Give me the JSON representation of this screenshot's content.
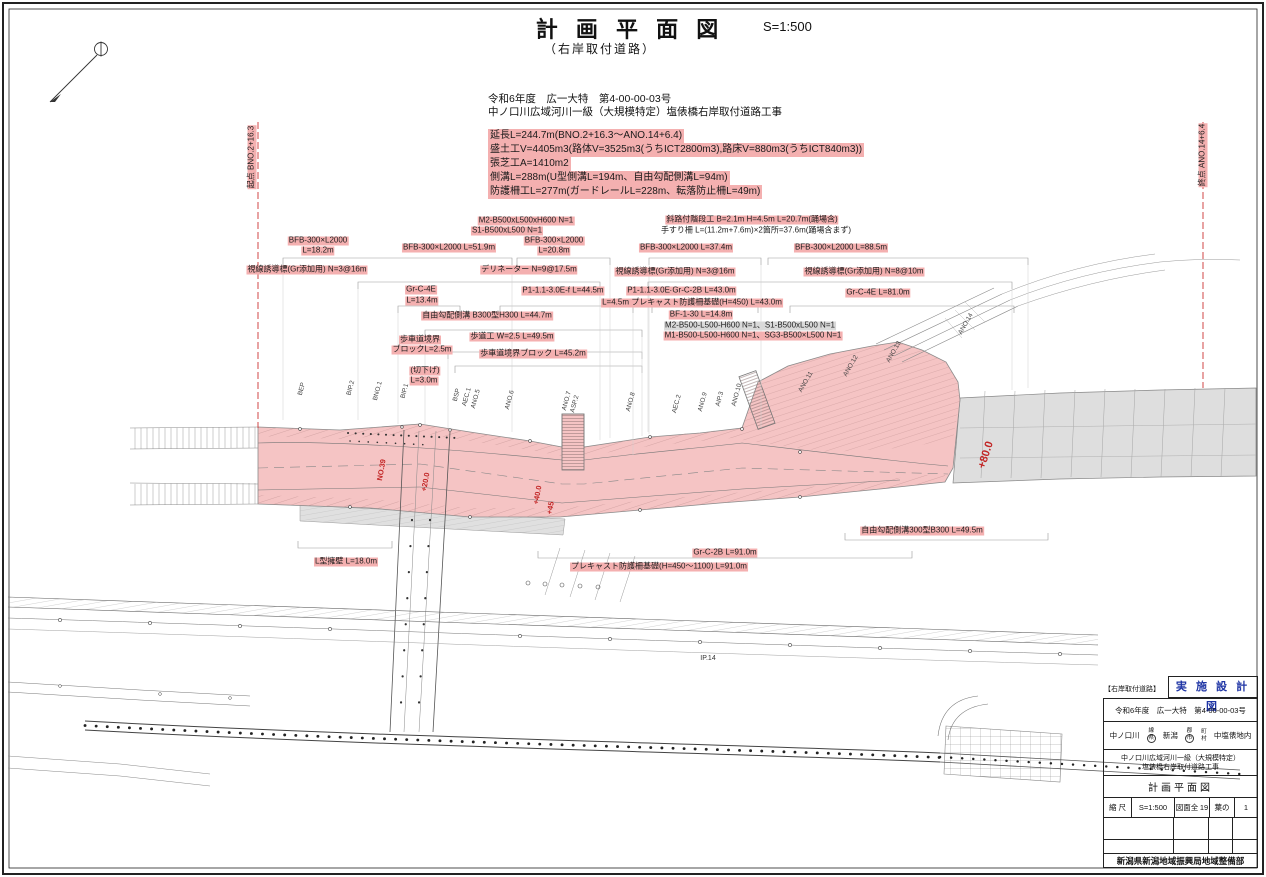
{
  "page": {
    "title": "計 画 平 面 図",
    "scale": "S=1:500",
    "subtitle": "（右岸取付道路）",
    "header1": "令和6年度　広一大特　第4-00-00-03号",
    "header2": "中ノ口川広域河川一級（大規模特定）塩俵橋右岸取付道路工事"
  },
  "colors": {
    "highlight_pink": "#f4b0b0",
    "embankment_pink": "#f5c4c4",
    "existing_gray": "#dedede",
    "chainage_red": "#c22626",
    "stamp_blue": "#1f35a5"
  },
  "summary": {
    "lines": [
      "延長L=244.7m(BNO.2+16.3〜ANO.14+6.4)",
      "盛土工V=4405m3(路体V=3525m3(うちICT2800m3),路床V=880m3(うちICT840m3))",
      "張芝工A=1410m2",
      "側溝L=288m(U型側溝L=194m、自由勾配側溝L=94m)",
      "防護柵工L=277m(ガードレールL=228m、転落防止柵L=49m)"
    ]
  },
  "map_labels": [
    {
      "t": "M2-B500xL500xH600 N=1",
      "x": 526,
      "y": 221,
      "bg": "pink"
    },
    {
      "t": "S1-B500xL500 N=1",
      "x": 507,
      "y": 231,
      "bg": "pink"
    },
    {
      "t": "BFB-300×L2000",
      "x": 318,
      "y": 241,
      "bg": "pink"
    },
    {
      "t": "L=18.2m",
      "x": 318,
      "y": 251,
      "bg": "pink"
    },
    {
      "t": "BFB-300×L2000 L=51.9m",
      "x": 449,
      "y": 248,
      "bg": "pink"
    },
    {
      "t": "BFB-300×L2000",
      "x": 554,
      "y": 241,
      "bg": "pink"
    },
    {
      "t": "L=20.8m",
      "x": 554,
      "y": 251,
      "bg": "pink"
    },
    {
      "t": "斜路付階段工 B=2.1m H=4.5m L=20.7m(踊場含)",
      "x": 752,
      "y": 220,
      "bg": "pink"
    },
    {
      "t": "手すり柵 L=(11.2m+7.6m)×2箇所=37.6m(踊場含まず)",
      "x": 756,
      "y": 231
    },
    {
      "t": "BFB-300×L2000 L=37.4m",
      "x": 686,
      "y": 248,
      "bg": "pink"
    },
    {
      "t": "BFB-300×L2000 L=88.5m",
      "x": 841,
      "y": 248,
      "bg": "pink"
    },
    {
      "t": "視線誘導標(Gr添加用) N=3@16m",
      "x": 307,
      "y": 270,
      "bg": "pink"
    },
    {
      "t": "デリネーター N=9@17.5m",
      "x": 529,
      "y": 270,
      "bg": "pink"
    },
    {
      "t": "視線誘導標(Gr添加用) N=3@16m",
      "x": 675,
      "y": 272,
      "bg": "pink"
    },
    {
      "t": "視線誘導標(Gr添加用) N=8@10m",
      "x": 864,
      "y": 272,
      "bg": "pink"
    },
    {
      "t": "Gr-C-4E",
      "x": 421,
      "y": 290,
      "bg": "pink"
    },
    {
      "t": "L=13.4m",
      "x": 422,
      "y": 301,
      "bg": "pink"
    },
    {
      "t": "P1-1.1-3.0E-f L=44.5m",
      "x": 563,
      "y": 291,
      "bg": "pink"
    },
    {
      "t": "P1-1.1-3.0E-f",
      "x": 651,
      "y": 291,
      "bg": "pink"
    },
    {
      "t": "Gr-C-2B L=43.0m",
      "x": 704,
      "y": 291,
      "bg": "pink"
    },
    {
      "t": "Gr-C-4E L=81.0m",
      "x": 878,
      "y": 293,
      "bg": "pink"
    },
    {
      "t": "L=4.5m プレキャスト防護柵基礎(H=450) L=43.0m",
      "x": 692,
      "y": 303,
      "bg": "pink"
    },
    {
      "t": "自由勾配側溝 B300型H300 L=44.7m",
      "x": 487,
      "y": 316,
      "bg": "pink"
    },
    {
      "t": "BF-1-30 L=14.8m",
      "x": 701,
      "y": 315,
      "bg": "pink"
    },
    {
      "t": "M2-B500-L500-H600 N=1、S1-B500xL500 N=1",
      "x": 750,
      "y": 326,
      "bg": "gray"
    },
    {
      "t": "M1-B500-L500-H600 N=1、SG3-B500×L500 N=1",
      "x": 753,
      "y": 336,
      "bg": "pink"
    },
    {
      "t": "歩道工 W=2.5 L=49.5m",
      "x": 512,
      "y": 337,
      "bg": "pink"
    },
    {
      "t": "歩車道境界",
      "x": 420,
      "y": 340,
      "bg": "pink"
    },
    {
      "t": "ブロックL=2.5m",
      "x": 422,
      "y": 350,
      "bg": "pink"
    },
    {
      "t": "歩車道境界ブロック L=45.2m",
      "x": 533,
      "y": 354,
      "bg": "pink"
    },
    {
      "t": "(切下げ)",
      "x": 425,
      "y": 371,
      "bg": "pink"
    },
    {
      "t": "L=3.0m",
      "x": 424,
      "y": 381,
      "bg": "pink"
    },
    {
      "t": "L型擁壁 L=18.0m",
      "x": 346,
      "y": 562,
      "bg": "pink"
    },
    {
      "t": "Gr-C-2B L=91.0m",
      "x": 725,
      "y": 553,
      "bg": "pink"
    },
    {
      "t": "プレキャスト防護柵基礎(H=450〜1100) L=91.0m",
      "x": 659,
      "y": 567,
      "bg": "pink"
    },
    {
      "t": "自由勾配側溝300型B300 L=49.5m",
      "x": 922,
      "y": 531,
      "bg": "pink"
    },
    {
      "t": "起点 BNO.2+16.3",
      "x": 252,
      "y": 157,
      "rot": -90,
      "bg": "pink"
    },
    {
      "t": "終点 ANO.14+6.4",
      "x": 1203,
      "y": 155,
      "rot": -90,
      "bg": "pink"
    },
    {
      "t": "BEP",
      "x": 302,
      "y": 389,
      "rot": -75,
      "cls": "sta"
    },
    {
      "t": "BIP.2",
      "x": 351,
      "y": 388,
      "rot": -75,
      "cls": "sta"
    },
    {
      "t": "BNO.1",
      "x": 378,
      "y": 391,
      "rot": -75,
      "cls": "sta"
    },
    {
      "t": "BIP.1",
      "x": 405,
      "y": 391,
      "rot": -75,
      "cls": "sta"
    },
    {
      "t": "BSP",
      "x": 457,
      "y": 395,
      "rot": -75,
      "cls": "sta"
    },
    {
      "t": "AEC.1",
      "x": 467,
      "y": 397,
      "rot": -75,
      "cls": "sta"
    },
    {
      "t": "ANO.5",
      "x": 476,
      "y": 399,
      "rot": -75,
      "cls": "sta"
    },
    {
      "t": "ANO.6",
      "x": 510,
      "y": 400,
      "rot": -75,
      "cls": "sta"
    },
    {
      "t": "ANO.7",
      "x": 567,
      "y": 401,
      "rot": -75,
      "cls": "sta"
    },
    {
      "t": "ASP.2",
      "x": 575,
      "y": 404,
      "rot": -75,
      "cls": "sta"
    },
    {
      "t": "ANO.8",
      "x": 631,
      "y": 402,
      "rot": -75,
      "cls": "sta"
    },
    {
      "t": "AEC.2",
      "x": 677,
      "y": 404,
      "rot": -75,
      "cls": "sta"
    },
    {
      "t": "ANO.9",
      "x": 703,
      "y": 402,
      "rot": -75,
      "cls": "sta"
    },
    {
      "t": "AIP.3",
      "x": 720,
      "y": 399,
      "rot": -75,
      "cls": "sta"
    },
    {
      "t": "ANO.10",
      "x": 737,
      "y": 395,
      "rot": -75,
      "cls": "sta"
    },
    {
      "t": "ANO.11",
      "x": 806,
      "y": 382,
      "rot": -60,
      "cls": "sta"
    },
    {
      "t": "ANO.12",
      "x": 851,
      "y": 366,
      "rot": -60,
      "cls": "sta"
    },
    {
      "t": "ANO.13",
      "x": 894,
      "y": 352,
      "rot": -60,
      "cls": "sta"
    },
    {
      "t": "ANO.14",
      "x": 966,
      "y": 324,
      "rot": -60,
      "cls": "sta"
    },
    {
      "t": "NO.39",
      "x": 382,
      "y": 470,
      "rot": -80,
      "cls": "red"
    },
    {
      "t": "+20.0",
      "x": 426,
      "y": 482,
      "rot": -80,
      "cls": "red"
    },
    {
      "t": "+40.0",
      "x": 538,
      "y": 495,
      "rot": -80,
      "cls": "red"
    },
    {
      "t": "+45",
      "x": 551,
      "y": 508,
      "rot": -80,
      "cls": "red"
    },
    {
      "t": "+80.0",
      "x": 986,
      "y": 455,
      "rot": -72,
      "cls": "redbig"
    },
    {
      "t": "IP.14",
      "x": 708,
      "y": 659,
      "cls": "blk"
    }
  ],
  "title_block": {
    "side_note": "【右岸取付道路】",
    "stamp": "実 施 設 計 図",
    "row1": "令和6年度　広一大特　第4-00-00-03号",
    "river": "中ノ口川",
    "sen": "線",
    "ken": "県",
    "pref": "新潟",
    "gun": "郡",
    "shi": "市",
    "cho": "町",
    "son": "村",
    "location": "中塩俵地内",
    "project1": "中ノ口川広域河川一級（大規模特定）",
    "project2": "塩俵橋右岸取付道路工事",
    "sheet_title": "計画平面図",
    "scale_label": "縮 尺",
    "scale_value": "S=1:500",
    "sheets_label": "図面全",
    "sheets_total": "19",
    "leaf_label": "葉の",
    "leaf_num": "1",
    "org": "新潟県新潟地域振興局地域整備部"
  }
}
